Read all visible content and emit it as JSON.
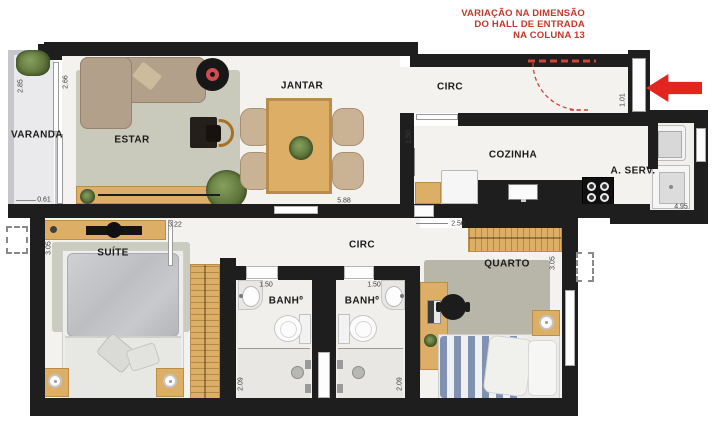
{
  "note": {
    "lines": [
      "VARIAÇÃO NA DIMENSÃO",
      "DO HALL DE ENTRADA",
      "NA COLUNA 13"
    ]
  },
  "rooms": {
    "varanda": "VARANDA",
    "estar": "ESTAR",
    "jantar": "JANTAR",
    "circ_hall": "CIRC",
    "cozinha": "COZINHA",
    "area_servico": "A. SERV.",
    "suite": "SUÍTE",
    "circ_quartos": "CIRC",
    "banheiro1": "BANHº",
    "banheiro2": "BANHº",
    "quarto": "QUARTO"
  },
  "dims": {
    "varanda_height": "2.85",
    "estar_height": "2.66",
    "varanda_width": "0.61",
    "jantar_width": "5.88",
    "cozinha_entry": "1.50",
    "hall_entry": "1.01",
    "aserv_width": "4.95",
    "suite_width": "3.22",
    "suite_height": "3.05",
    "quarto_entry": "2.50",
    "quarto_height": "3.05",
    "banheiro1_width": "1.50",
    "banheiro2_width": "1.50",
    "banheiro1_depth": "2.09",
    "banheiro2_depth": "2.09"
  },
  "colors": {
    "wall": "#1e1e1e",
    "wood": "#dcae66",
    "floor": "#f4f2ef",
    "rug": "#c9cabc",
    "annotation_red": "#c0392b",
    "arrow_red": "#e3261d"
  }
}
